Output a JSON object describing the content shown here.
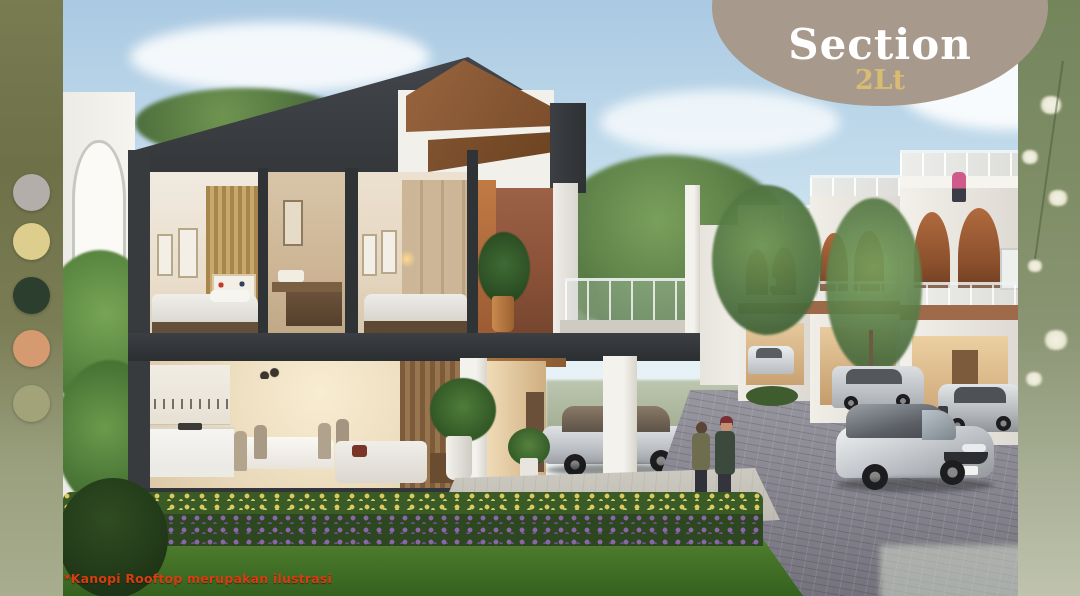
{
  "slide": {
    "title": "Section",
    "subtitle": "2Lt",
    "disclaimer": "*Kanopi Rooftop merupakan ilustrasi"
  },
  "palette": {
    "swatches": [
      {
        "name": "warm-grey",
        "hex": "#b3aeaa"
      },
      {
        "name": "pale-gold",
        "hex": "#ddce8d"
      },
      {
        "name": "forest-green",
        "hex": "#2c3e2d"
      },
      {
        "name": "terracotta",
        "hex": "#d69a70"
      },
      {
        "name": "sage-olive",
        "hex": "#a3a379"
      }
    ]
  },
  "colors": {
    "badge_bg": "#a79a8c",
    "badge_title": "#ffffff",
    "badge_subtitle": "#d8bc72",
    "disclaimer": "#d93c10",
    "structure": "#383b3e",
    "wood_canopy": "#8a5a38",
    "terracotta_wall": "#9c6248",
    "sky_top": "#aac9e2",
    "sky_horizon": "#eaf3f6",
    "lawn": "#45722c",
    "street": "#8f8f98",
    "strip_left_olive": "#7a7c52",
    "strip_right_botanical": "#7e8d66"
  }
}
